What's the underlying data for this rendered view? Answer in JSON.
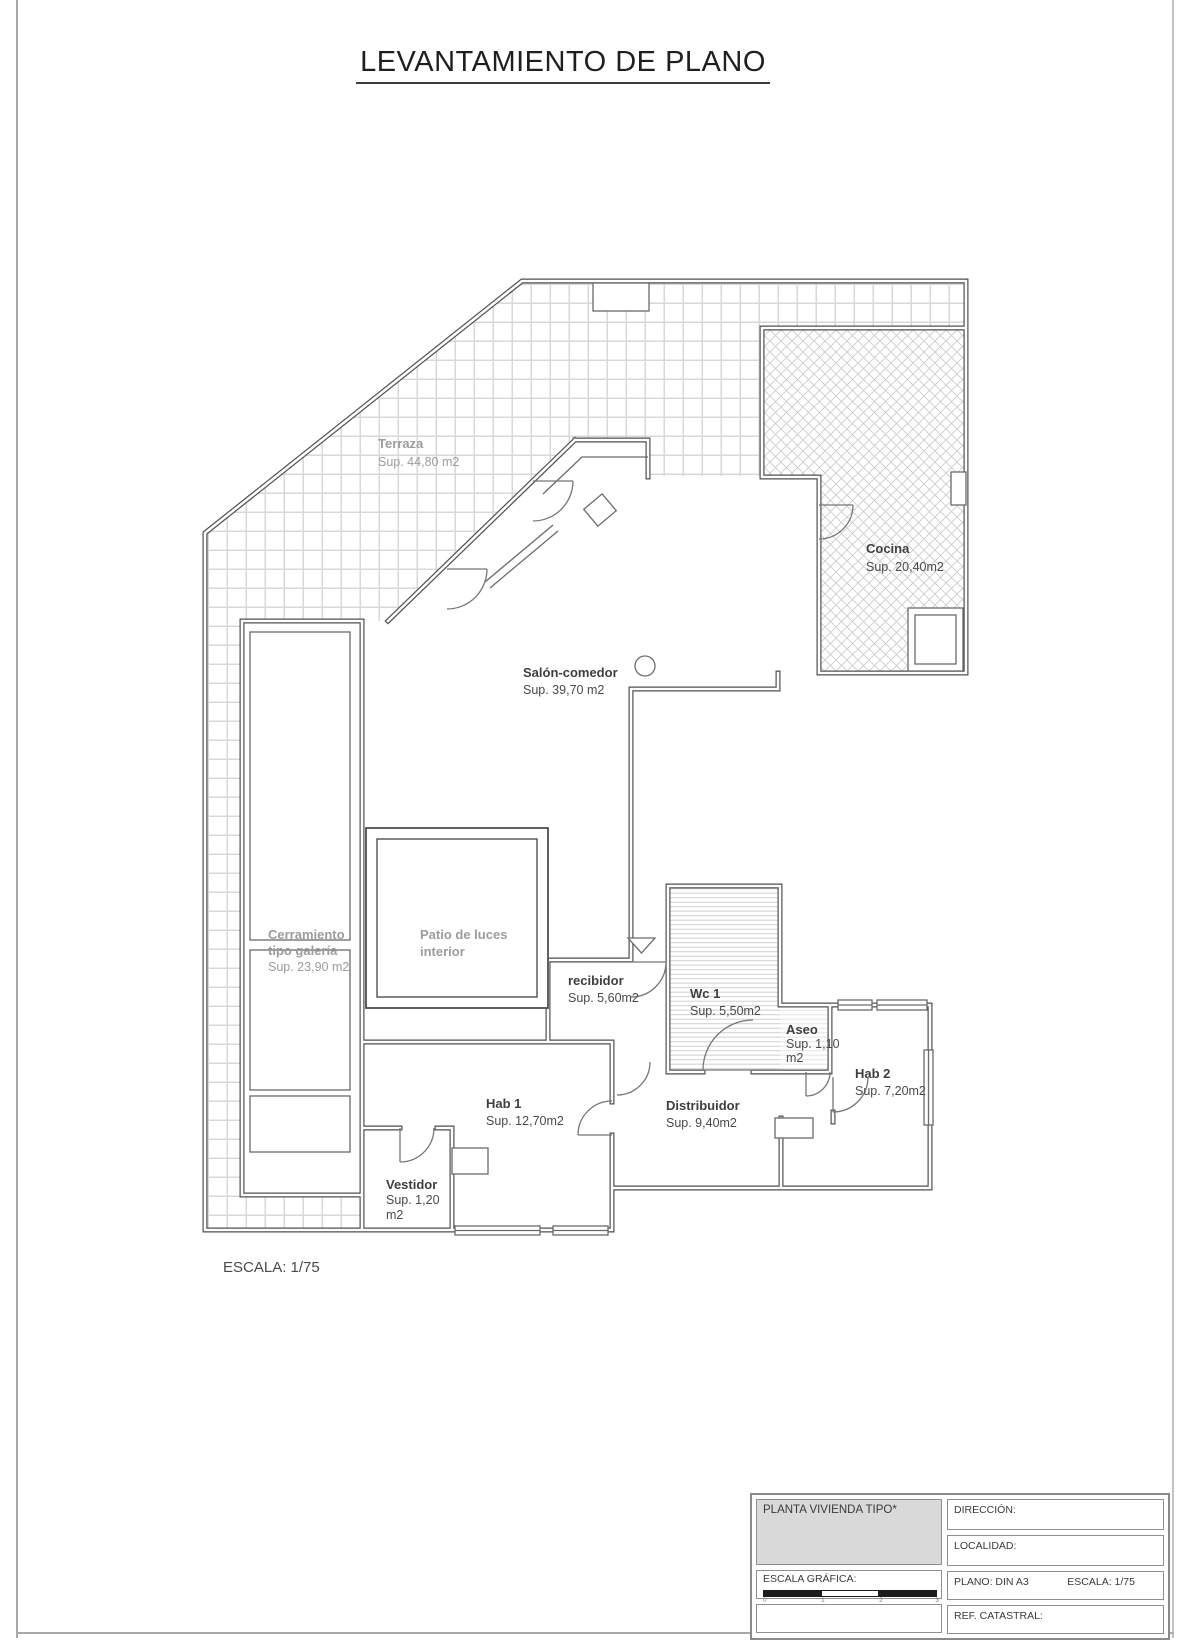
{
  "page": {
    "title": "LEVANTAMIENTO DE PLANO",
    "scale_note": "ESCALA: 1/75"
  },
  "rooms": {
    "terraza": {
      "name": "Terraza",
      "area": "Sup. 44,80 m2"
    },
    "cocina": {
      "name": "Cocina",
      "area": "Sup. 20,40m2"
    },
    "salon_comedor": {
      "name": "Salón-comedor",
      "area": "Sup. 39,70 m2"
    },
    "cerramiento": {
      "name": "Cerramiento",
      "name2": "tipo galería",
      "area": "Sup. 23,90 m2"
    },
    "patio": {
      "name": "Patio de luces",
      "name2": "interior"
    },
    "recibidor": {
      "name": "recibidor",
      "area": "Sup. 5,60m2"
    },
    "wc1": {
      "name": "Wc 1",
      "area": "Sup. 5,50m2"
    },
    "aseo": {
      "name": "Aseo",
      "area": "Sup. 1,10",
      "area2": "m2"
    },
    "hab2": {
      "name": "Hab 2",
      "area": "Sup. 7,20m2"
    },
    "hab1": {
      "name": "Hab 1",
      "area": "Sup. 12,70m2"
    },
    "distribuidor": {
      "name": "Distribuidor",
      "area": "Sup. 9,40m2"
    },
    "vestidor": {
      "name": "Vestidor",
      "area": "Sup. 1,20",
      "area2": "m2"
    }
  },
  "title_block": {
    "plan_name": "PLANTA VIVIENDA TIPO*",
    "direccion_label": "DIRECCIÓN:",
    "localidad_label": "LOCALIDAD:",
    "escala_grafica_label": "ESCALA GRÁFICA:",
    "plano_label": "PLANO: DIN A3",
    "escala_label": "ESCALA: 1/75",
    "ref_catastral_label": "REF. CATASTRAL:",
    "scale_bar_ticks": [
      "0",
      "1",
      "2",
      "3"
    ]
  },
  "colors": {
    "wall": "#4f4f4f",
    "hatch_line": "#d8d8d8",
    "label_gray": "#9c9c9c",
    "label_dark": "#3f3f3f",
    "scale_bar": "#1c1c1c",
    "title_block_fill": "#d9d9d9"
  }
}
